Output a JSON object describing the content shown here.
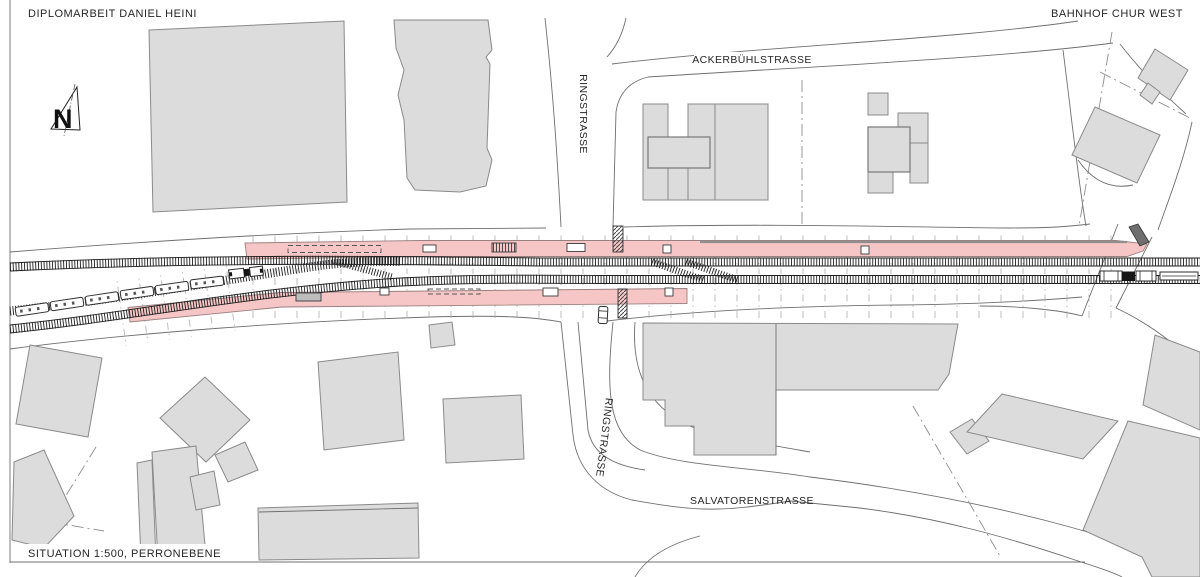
{
  "drawing": {
    "title_left": "DIPLOMARBEIT DANIEL HEINI",
    "title_right": "BAHNHOF CHUR WEST",
    "caption": "SITUATION 1:500, PERRONEBENE",
    "north_arrow_letter": "N",
    "streets": {
      "ackerbuehlstrasse": "ACKERBÜHLSTRASSE",
      "ringstrasse_north": "RINGSTRASSE",
      "ringstrasse_south": "RINGSTRASSE",
      "salvatorenstrasse": "SALVATORENSTRASSE"
    },
    "colors": {
      "platform": "#f6c6c6",
      "platform-stroke": "#9b8080",
      "building": "#dcdcdc",
      "building-stroke": "#8a8a8a",
      "ink": "#1f1f1f",
      "line": "#6f6f6f"
    }
  }
}
